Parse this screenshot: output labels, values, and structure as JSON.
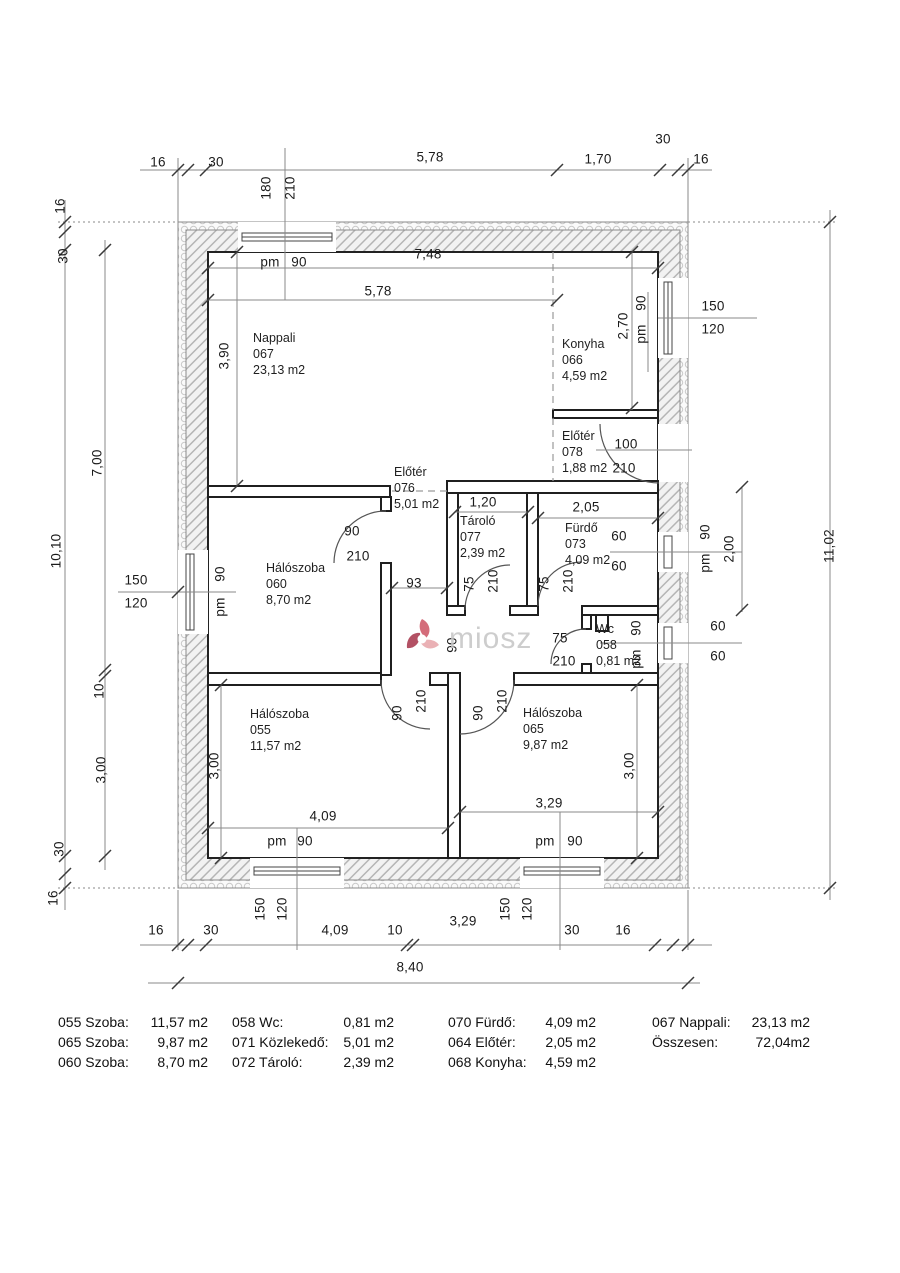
{
  "watermark": {
    "text": "miosz"
  },
  "colors": {
    "wall_line": "#2b2b2b",
    "dim_line": "#8a8a8a",
    "hatch": "#b5b5b5",
    "insulation": "#c9c9c9",
    "watermark_text": "#c7c7c7",
    "logo_pink": "#e8a7ab",
    "logo_red": "#cf5868",
    "logo_dark_red": "#a93a4f"
  },
  "rooms": [
    {
      "name": "Nappali",
      "code": "067",
      "area": "23,13 m2",
      "x": 253,
      "y": 330
    },
    {
      "name": "Konyha",
      "code": "066",
      "area": "4,59 m2",
      "x": 562,
      "y": 336
    },
    {
      "name": "Előtér",
      "code": "078",
      "area": "1,88 m2",
      "x": 562,
      "y": 428
    },
    {
      "name": "Előtér",
      "code": "076",
      "area": "5,01 m2",
      "x": 394,
      "y": 464
    },
    {
      "name": "Tároló",
      "code": "077",
      "area": "2,39 m2",
      "x": 460,
      "y": 513
    },
    {
      "name": "Fürdő",
      "code": "073",
      "area": "4,09 m2",
      "x": 565,
      "y": 520
    },
    {
      "name": "Hálószoba",
      "code": "060",
      "area": "8,70 m2",
      "x": 266,
      "y": 560
    },
    {
      "name": "Wc",
      "code": "058",
      "area": "0,81 m2",
      "x": 596,
      "y": 621
    },
    {
      "name": "Hálószoba",
      "code": "055",
      "area": "11,57 m2",
      "x": 250,
      "y": 706
    },
    {
      "name": "Hálószoba",
      "code": "065",
      "area": "9,87 m2",
      "x": 523,
      "y": 705
    }
  ],
  "dim_labels": [
    {
      "t": "16",
      "x": 158,
      "y": 162
    },
    {
      "t": "30",
      "x": 216,
      "y": 162
    },
    {
      "t": "5,78",
      "x": 430,
      "y": 157
    },
    {
      "t": "1,70",
      "x": 598,
      "y": 159
    },
    {
      "t": "30",
      "x": 663,
      "y": 139
    },
    {
      "t": "16",
      "x": 701,
      "y": 159
    },
    {
      "t": "180",
      "x": 266,
      "y": 188,
      "r": 1
    },
    {
      "t": "210",
      "x": 290,
      "y": 188,
      "r": 1
    },
    {
      "t": "pm",
      "x": 270,
      "y": 262
    },
    {
      "t": "90",
      "x": 299,
      "y": 262
    },
    {
      "t": "7,48",
      "x": 428,
      "y": 254
    },
    {
      "t": "5,78",
      "x": 378,
      "y": 291
    },
    {
      "t": "16",
      "x": 60,
      "y": 206,
      "r": 1
    },
    {
      "t": "30",
      "x": 63,
      "y": 256,
      "r": 1
    },
    {
      "t": "3,90",
      "x": 224,
      "y": 356,
      "r": 1
    },
    {
      "t": "7,00",
      "x": 97,
      "y": 463,
      "r": 1
    },
    {
      "t": "10,10",
      "x": 56,
      "y": 551,
      "r": 1
    },
    {
      "t": "150",
      "x": 136,
      "y": 580
    },
    {
      "t": "120",
      "x": 136,
      "y": 603
    },
    {
      "t": "90",
      "x": 220,
      "y": 574,
      "r": 1
    },
    {
      "t": "pm",
      "x": 220,
      "y": 607,
      "r": 1
    },
    {
      "t": "10",
      "x": 99,
      "y": 691,
      "r": 1
    },
    {
      "t": "3,00",
      "x": 101,
      "y": 770,
      "r": 1
    },
    {
      "t": "30",
      "x": 59,
      "y": 849,
      "r": 1
    },
    {
      "t": "16",
      "x": 53,
      "y": 898,
      "r": 1
    },
    {
      "t": "2,70",
      "x": 623,
      "y": 326,
      "r": 1
    },
    {
      "t": "90",
      "x": 641,
      "y": 303,
      "r": 1
    },
    {
      "t": "pm",
      "x": 641,
      "y": 334,
      "r": 1
    },
    {
      "t": "150",
      "x": 713,
      "y": 306
    },
    {
      "t": "120",
      "x": 713,
      "y": 329
    },
    {
      "t": "100",
      "x": 626,
      "y": 444
    },
    {
      "t": "210",
      "x": 624,
      "y": 468
    },
    {
      "t": "90",
      "x": 352,
      "y": 531
    },
    {
      "t": "210",
      "x": 358,
      "y": 556
    },
    {
      "t": "93",
      "x": 414,
      "y": 583
    },
    {
      "t": "1,20",
      "x": 483,
      "y": 502
    },
    {
      "t": "2,05",
      "x": 586,
      "y": 507
    },
    {
      "t": "75",
      "x": 469,
      "y": 584,
      "r": 1
    },
    {
      "t": "210",
      "x": 493,
      "y": 581,
      "r": 1
    },
    {
      "t": "75",
      "x": 544,
      "y": 584,
      "r": 1
    },
    {
      "t": "210",
      "x": 568,
      "y": 581,
      "r": 1
    },
    {
      "t": "60",
      "x": 619,
      "y": 536
    },
    {
      "t": "60",
      "x": 619,
      "y": 566
    },
    {
      "t": "90",
      "x": 705,
      "y": 532,
      "r": 1
    },
    {
      "t": "pm",
      "x": 705,
      "y": 563,
      "r": 1
    },
    {
      "t": "2,00",
      "x": 729,
      "y": 549,
      "r": 1
    },
    {
      "t": "90",
      "x": 452,
      "y": 645,
      "r": 1
    },
    {
      "t": "75",
      "x": 560,
      "y": 638
    },
    {
      "t": "210",
      "x": 564,
      "y": 661
    },
    {
      "t": "90",
      "x": 636,
      "y": 628,
      "r": 1
    },
    {
      "t": "pm",
      "x": 636,
      "y": 659,
      "r": 1
    },
    {
      "t": "60",
      "x": 718,
      "y": 626
    },
    {
      "t": "60",
      "x": 718,
      "y": 656
    },
    {
      "t": "11,02",
      "x": 829,
      "y": 546,
      "r": 1
    },
    {
      "t": "90",
      "x": 397,
      "y": 713,
      "r": 1
    },
    {
      "t": "210",
      "x": 421,
      "y": 701,
      "r": 1
    },
    {
      "t": "90",
      "x": 478,
      "y": 713,
      "r": 1
    },
    {
      "t": "210",
      "x": 502,
      "y": 701,
      "r": 1
    },
    {
      "t": "3,00",
      "x": 214,
      "y": 766,
      "r": 1
    },
    {
      "t": "3,00",
      "x": 629,
      "y": 766,
      "r": 1
    },
    {
      "t": "4,09",
      "x": 323,
      "y": 816
    },
    {
      "t": "3,29",
      "x": 549,
      "y": 803
    },
    {
      "t": "pm",
      "x": 277,
      "y": 841
    },
    {
      "t": "90",
      "x": 305,
      "y": 841
    },
    {
      "t": "pm",
      "x": 545,
      "y": 841
    },
    {
      "t": "90",
      "x": 575,
      "y": 841
    },
    {
      "t": "150",
      "x": 260,
      "y": 909,
      "r": 1
    },
    {
      "t": "120",
      "x": 282,
      "y": 909,
      "r": 1
    },
    {
      "t": "150",
      "x": 505,
      "y": 909,
      "r": 1
    },
    {
      "t": "120",
      "x": 527,
      "y": 909,
      "r": 1
    },
    {
      "t": "16",
      "x": 156,
      "y": 930
    },
    {
      "t": "30",
      "x": 211,
      "y": 930
    },
    {
      "t": "4,09",
      "x": 335,
      "y": 930
    },
    {
      "t": "10",
      "x": 395,
      "y": 930
    },
    {
      "t": "3,29",
      "x": 463,
      "y": 921
    },
    {
      "t": "30",
      "x": 572,
      "y": 930
    },
    {
      "t": "16",
      "x": 623,
      "y": 930
    },
    {
      "t": "8,40",
      "x": 410,
      "y": 967
    }
  ],
  "legend": {
    "columns": [
      [
        {
          "label": "055 Szoba:",
          "value": "11,57 m2"
        },
        {
          "label": "065 Szoba:",
          "value": "9,87 m2"
        },
        {
          "label": "060 Szoba:",
          "value": "8,70 m2"
        }
      ],
      [
        {
          "label": "058 Wc:",
          "value": "0,81 m2"
        },
        {
          "label": "071 Közlekedő:",
          "value": "5,01 m2"
        },
        {
          "label": "072 Tároló:",
          "value": "2,39 m2"
        }
      ],
      [
        {
          "label": "070 Fürdő:",
          "value": "4,09 m2"
        },
        {
          "label": "064 Előtér:",
          "value": "2,05 m2"
        },
        {
          "label": "068 Konyha:",
          "value": "4,59 m2"
        }
      ],
      [
        {
          "label": "067 Nappali:",
          "value": "23,13 m2"
        },
        {
          "label": "Összesen:",
          "value": "72,04m2"
        }
      ]
    ]
  }
}
